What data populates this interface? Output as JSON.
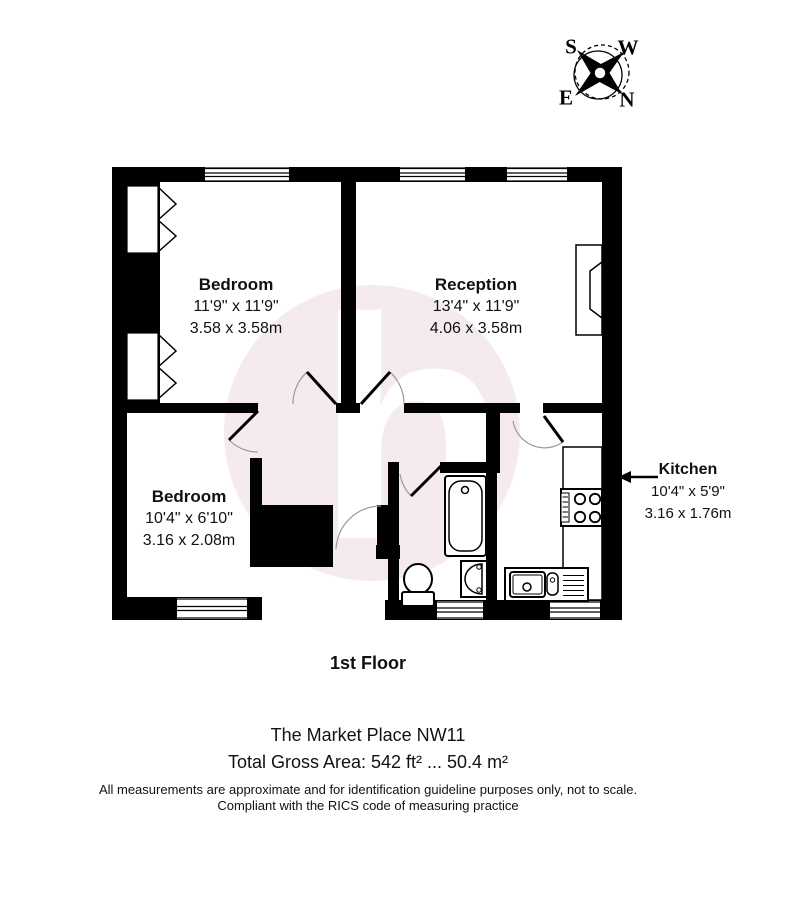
{
  "compass": {
    "s": "S",
    "w": "W",
    "e": "E",
    "n": "N"
  },
  "watermark": {
    "letter": "h"
  },
  "rooms": {
    "bedroom1": {
      "name": "Bedroom",
      "imperial": "11'9\" x 11'9\"",
      "metric": "3.58 x 3.58m"
    },
    "reception": {
      "name": "Reception",
      "imperial": "13'4\" x 11'9\"",
      "metric": "4.06 x 3.58m"
    },
    "bedroom2": {
      "name": "Bedroom",
      "imperial": "10'4\" x 6'10\"",
      "metric": "3.16 x 2.08m"
    },
    "kitchen": {
      "name": "Kitchen",
      "imperial": "10'4\" x 5'9\"",
      "metric": "3.16 x 1.76m"
    }
  },
  "footer": {
    "floor_label": "1st Floor",
    "address": "The Market Place NW11",
    "total_area": "Total Gross Area: 542 ft² ... 50.4 m²",
    "disclaimer_line1": "All measurements are approximate and for identification guideline purposes only, not to scale.",
    "disclaimer_line2": "Compliant with the RICS code of measuring practice"
  },
  "colors": {
    "wall": "#000000",
    "watermark_circle": "#f5ebec",
    "door_arc": "#9a9a9a"
  }
}
